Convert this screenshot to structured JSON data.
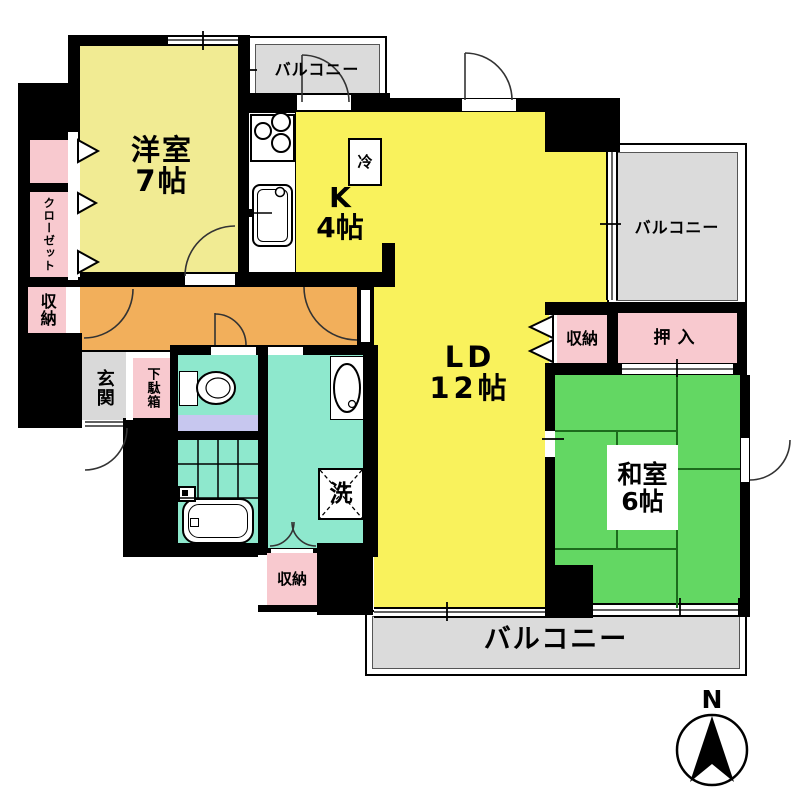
{
  "plan_title": "apartment-floor-plan",
  "rooms": {
    "western": {
      "name": "洋室",
      "size": "7帖"
    },
    "kitchen": {
      "name": "K",
      "size": "4帖"
    },
    "living_dining": {
      "name": "LD",
      "size": "12帖"
    },
    "japanese": {
      "name": "和室",
      "size": "6帖"
    }
  },
  "balconies": {
    "top": "バルコニー",
    "right": "バルコニー",
    "bottom": "バルコニー"
  },
  "storages": {
    "closet": "クローゼット",
    "storage_left": "収納",
    "storage_hall": "収納",
    "oshiire": "押入",
    "storage_bottom": "収納"
  },
  "fixtures": {
    "refrigerator": "冷",
    "laundry": "洗",
    "entrance": "玄関",
    "shoe_cabinet": "下駄箱"
  },
  "compass": {
    "north": "N"
  },
  "colors": {
    "room_yellow": "#F9F25C",
    "western_yellow": "#F1EB93",
    "corridor_orange": "#F2AF5B",
    "tatami_green": "#63D763",
    "wet_cyan": "#8EE8CD",
    "toilet_mat_lavender": "#C7C7EF",
    "storage_pink": "#F8C9CF",
    "balcony_gray": "#DBDBDB",
    "wall_black": "#000000"
  }
}
